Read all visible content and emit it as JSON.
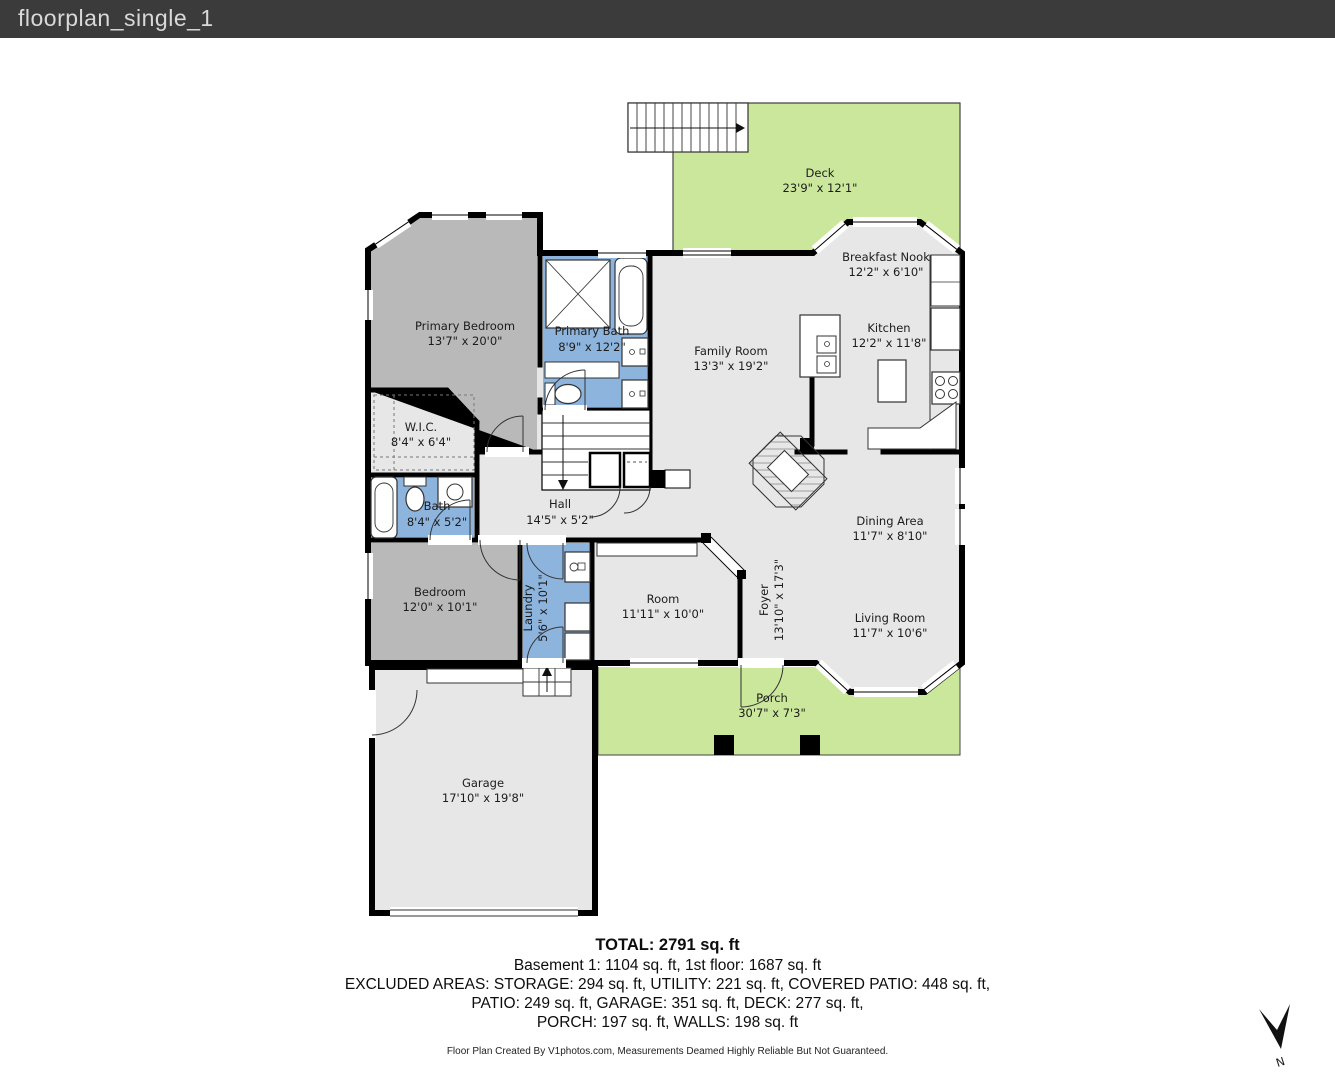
{
  "header": {
    "title": "floorplan_single_1"
  },
  "colors": {
    "titlebar_bg": "#3b3b3b",
    "outdoor_green": "#cbe79b",
    "room_gray": "#b9b9b9",
    "room_light": "#e7e7e7",
    "room_blue": "#8db4dd",
    "wall": "#000000"
  },
  "floorplan": {
    "rooms": [
      {
        "id": "deck",
        "name": "Deck",
        "dims": "23'9\" x 12'1\""
      },
      {
        "id": "breakfast-nook",
        "name": "Breakfast Nook",
        "dims": "12'2\" x 6'10\""
      },
      {
        "id": "kitchen",
        "name": "Kitchen",
        "dims": "12'2\" x 11'8\""
      },
      {
        "id": "primary-bedroom",
        "name": "Primary Bedroom",
        "dims": "13'7\" x 20'0\""
      },
      {
        "id": "primary-bath",
        "name": "Primary Bath",
        "dims": "8'9\" x 12'2\""
      },
      {
        "id": "family-room",
        "name": "Family Room",
        "dims": "13'3\" x 19'2\""
      },
      {
        "id": "wic",
        "name": "W.I.C.",
        "dims": "8'4\" x 6'4\""
      },
      {
        "id": "bath",
        "name": "Bath",
        "dims": "8'4\" x 5'2\""
      },
      {
        "id": "hall",
        "name": "Hall",
        "dims": "14'5\" x 5'2\""
      },
      {
        "id": "dining-area",
        "name": "Dining Area",
        "dims": "11'7\" x 8'10\""
      },
      {
        "id": "bedroom",
        "name": "Bedroom",
        "dims": "12'0\" x 10'1\""
      },
      {
        "id": "laundry",
        "name": "Laundry",
        "dims": "5'6\" x 10'1\""
      },
      {
        "id": "room",
        "name": "Room",
        "dims": "11'11\" x 10'0\""
      },
      {
        "id": "foyer",
        "name": "Foyer",
        "dims": "13'10\" x 17'3\""
      },
      {
        "id": "living-room",
        "name": "Living Room",
        "dims": "11'7\" x 10'6\""
      },
      {
        "id": "porch",
        "name": "Porch",
        "dims": "30'7\" x 7'3\""
      },
      {
        "id": "garage",
        "name": "Garage",
        "dims": "17'10\" x 19'8\""
      }
    ],
    "compass_label": "N"
  },
  "summary": {
    "total": "TOTAL: 2791 sq. ft",
    "line1": "Basement 1: 1104 sq. ft, 1st floor: 1687 sq. ft",
    "line2": "EXCLUDED AREAS: STORAGE: 294 sq. ft, UTILITY: 221 sq. ft, COVERED PATIO: 448 sq. ft,",
    "line3": "PATIO: 249 sq. ft, GARAGE: 351 sq. ft, DECK: 277 sq. ft,",
    "line4": "PORCH: 197 sq. ft, WALLS: 198 sq. ft"
  },
  "footer": {
    "credit": "Floor Plan Created By V1photos.com, Measurements Deamed Highly Reliable But Not Guaranteed."
  }
}
